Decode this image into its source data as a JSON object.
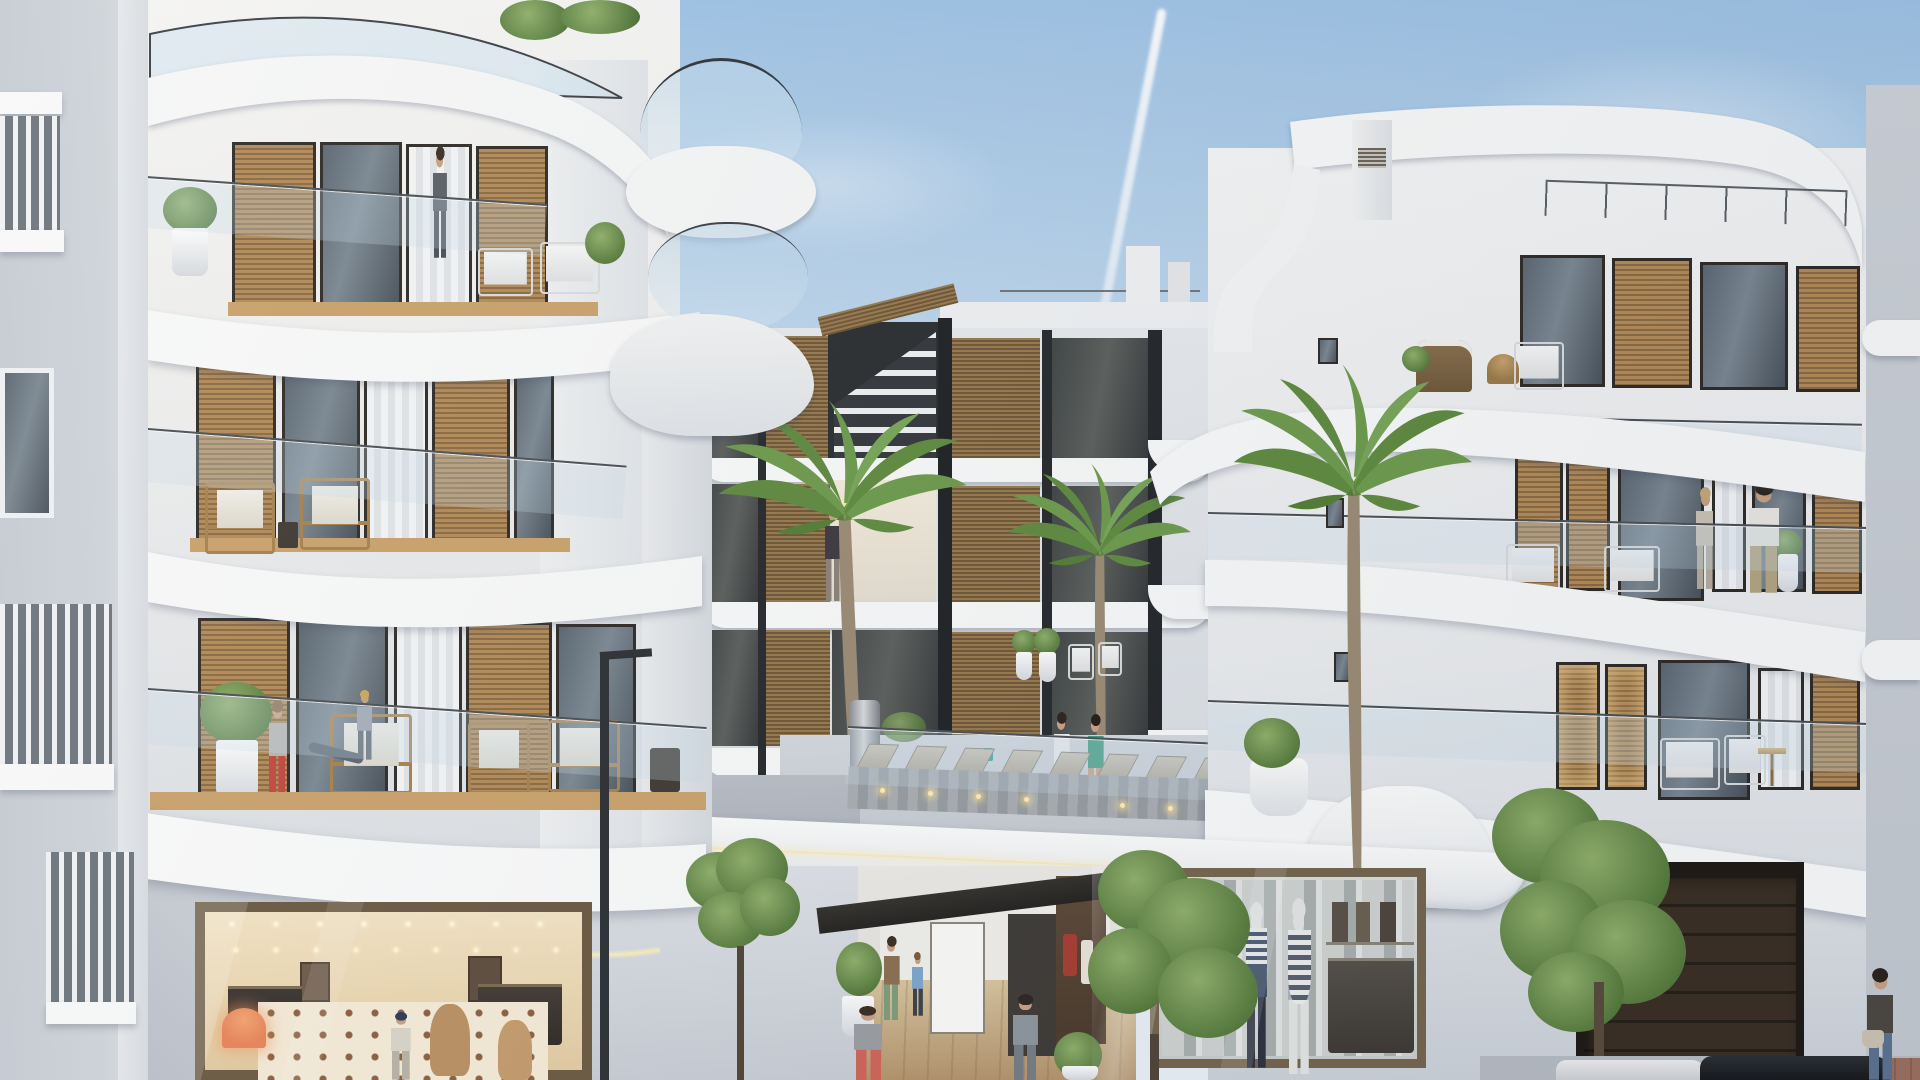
{
  "scene": {
    "type": "architectural-render",
    "description": "Photorealistic 3D rendering of a modern white Mediterranean apartment complex with curved balcony slabs, glass balustrades, wood-shutter windows, palm trees, a raised pool deck with sun loungers, street-level fashion boutiques, an entrance passage with pedestrians and a garage door, under a blue sky with a jet contrail",
    "time_of_day": "late afternoon",
    "weather": "clear blue sky with light clouds and one jet contrail"
  },
  "colors": {
    "sky_top": "#9ec2e4",
    "sky_mid": "#cfe0ef",
    "sky_horizon": "#eaf0f6",
    "wall_lit": "#f2f2f1",
    "wall_mid": "#e7e9eb",
    "wall_shade": "#ccd2d9",
    "slab_white": "#f8f9f9",
    "wood_light": "#b28a58",
    "wood_dark": "#8a6a42",
    "frame_dark": "#2f2b26",
    "deck_wood": "#c9a26b",
    "glass_dark": "#5a6671",
    "courtyard_wood": "#96794e",
    "warm_interior": "#f2e3c4",
    "warm_glow": "#ffedb0",
    "led_strip": "#f6ecbe",
    "palm_green": "#6d9a4c",
    "palm_dark": "#557d36",
    "tree_green": "#6b8d52",
    "lounger_frame": "#a69d8e",
    "lounger_cushion": "#cdc5b6",
    "garage_door": "#34291e",
    "street_gray": "#b7bcc3",
    "paver_red": "#9c6f60",
    "accent_red_pants": "#c4473f",
    "accent_green_bikini": "#3f9e83",
    "accent_teal": "#2ba8a0",
    "jeans_blue": "#5d7191"
  },
  "inventory": {
    "buildings": [
      "far-left neighbour building",
      "left curved apartment building (4 levels + shop)",
      "recessed courtyard block with exterior stair",
      "right curved apartment building (4 levels + shops)",
      "far-right neighbour building"
    ],
    "palm_trees": 3,
    "street_trees": 3,
    "sun_loungers": 8,
    "people_total": 13,
    "ground_floor_units": [
      "warm-lit fashion boutique",
      "entrance passage with pedestrians",
      "boutique with two striped mannequins",
      "dark sectional garage door"
    ],
    "vehicles": [
      "white car roof",
      "dark car roof"
    ]
  },
  "people": [
    {
      "id": "man-top-left-balcony",
      "where": "penthouse balcony of left building"
    },
    {
      "id": "woman-courtyard-walkway",
      "where": "upper walkway of courtyard block"
    },
    {
      "id": "seated-woman-third-floor",
      "where": "third-floor balcony, left building"
    },
    {
      "id": "child-red-pants",
      "where": "third-floor balcony, left building"
    },
    {
      "id": "woman-white-top-pool-deck",
      "where": "pool deck"
    },
    {
      "id": "woman-green-bikini-pool-deck",
      "where": "pool deck"
    },
    {
      "id": "woman-right-balcony",
      "where": "mid-level balcony, right building"
    },
    {
      "id": "man-right-balcony",
      "where": "mid-level balcony, right building"
    },
    {
      "id": "woman-entrance-passage",
      "where": "entrance passage"
    },
    {
      "id": "child-entrance-passage",
      "where": "entrance passage"
    },
    {
      "id": "man-gray-tshirt",
      "where": "entrance passage foreground"
    },
    {
      "id": "man-gray-suit",
      "where": "entrance passage"
    },
    {
      "id": "woman-handbag-street",
      "where": "street, far right"
    }
  ]
}
